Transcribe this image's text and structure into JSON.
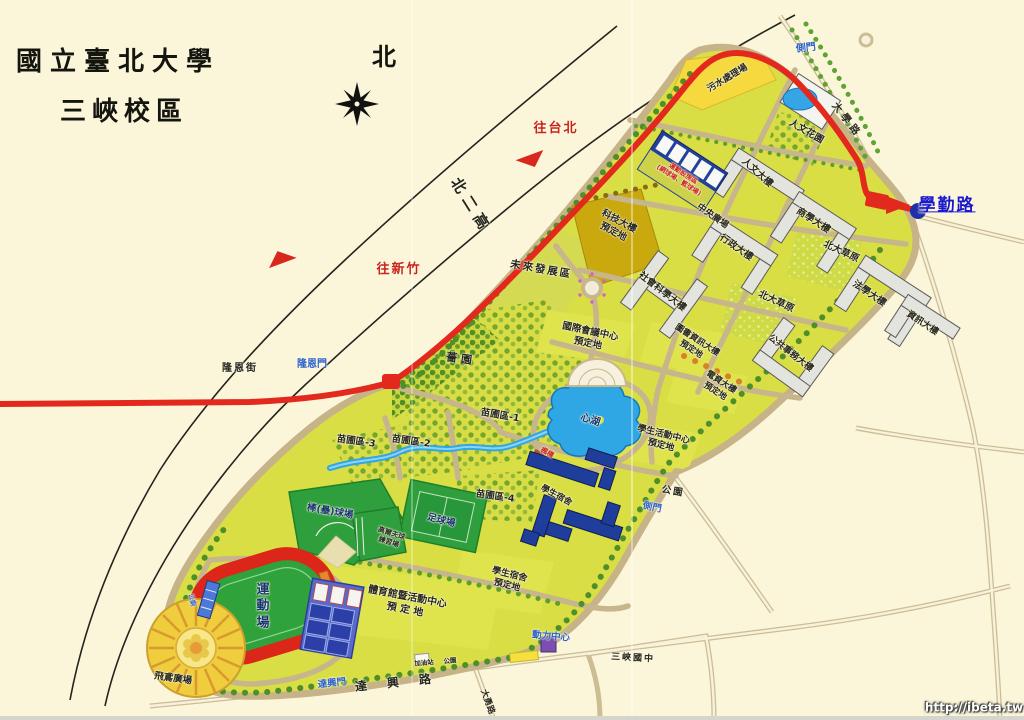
{
  "header": {
    "title1": "國立臺北大學",
    "title2": "三峽校區"
  },
  "compass": {
    "north": "北"
  },
  "highway": {
    "name": "北二高",
    "to_taipei": "往台北",
    "to_hsinchu": "往新竹"
  },
  "roads": {
    "daxue": "大學路",
    "xueqin": "學勤路",
    "longen_st": "隆恩街",
    "daxing": "達 興 路",
    "dayong": "大勇路"
  },
  "gates": {
    "longen": "隆恩門",
    "side_top": "側門",
    "side_right": "側門",
    "daxing": "達興門"
  },
  "buildings": {
    "humanities": "人文大樓",
    "business": "商學大樓",
    "admin": "行政大樓",
    "socsci": "社會科學大樓",
    "law": "法學大樓",
    "info": "資訊大樓",
    "pubaff": "公共事務大樓",
    "dorm": "學生宿舍",
    "power": "動力中心"
  },
  "areas": {
    "sewage": "污水處理場",
    "garden_humanities": "人文花園",
    "central_plaza": "中央廣場",
    "grass1": "北大草原",
    "grass2": "北大草原",
    "lib_planned": "圖書資訊大樓\n預定地",
    "elec_planned": "電資大樓\n預定地",
    "tech_planned": "科技大樓\n預定地",
    "future_dev": "未來發展區",
    "conf_planned": "國際會議中心\n預定地",
    "garden_qiang": "薔 園",
    "nursery1": "苗圃區-1",
    "nursery2": "苗圃區-2",
    "nursery3": "苗圃區-3",
    "nursery4": "苗圃區-4",
    "lake": "心湖",
    "activity_planned": "學生活動中心\n預定地",
    "park_right": "公園",
    "park_bottom": "公園",
    "dorm_planned": "學生宿舍\n預定地",
    "gym_planned": "體育館暨活動中心\n預 定 地",
    "school": "三峽國中",
    "toilet": "公廁",
    "gas": "加油站",
    "plaza": "飛鳶廣場",
    "bridge": "楓橋"
  },
  "sports": {
    "zone": "運動設施區\n(網球場、籃球場)",
    "baseball": "棒(壘)球場",
    "soccer": "足球場",
    "golf": "高爾夫球\n練習場",
    "track": "運\n動\n場"
  },
  "watermark": "http://ibeta.tw",
  "colors": {
    "background": "#FBF6DA",
    "campus_green": "#D9DE44",
    "route_red": "#E3281E",
    "lake_blue": "#2FA7E5",
    "link_blue": "#1A1ACC",
    "planned_khaki": "#C9A90E",
    "sewage_yellow": "#F5D93E"
  }
}
